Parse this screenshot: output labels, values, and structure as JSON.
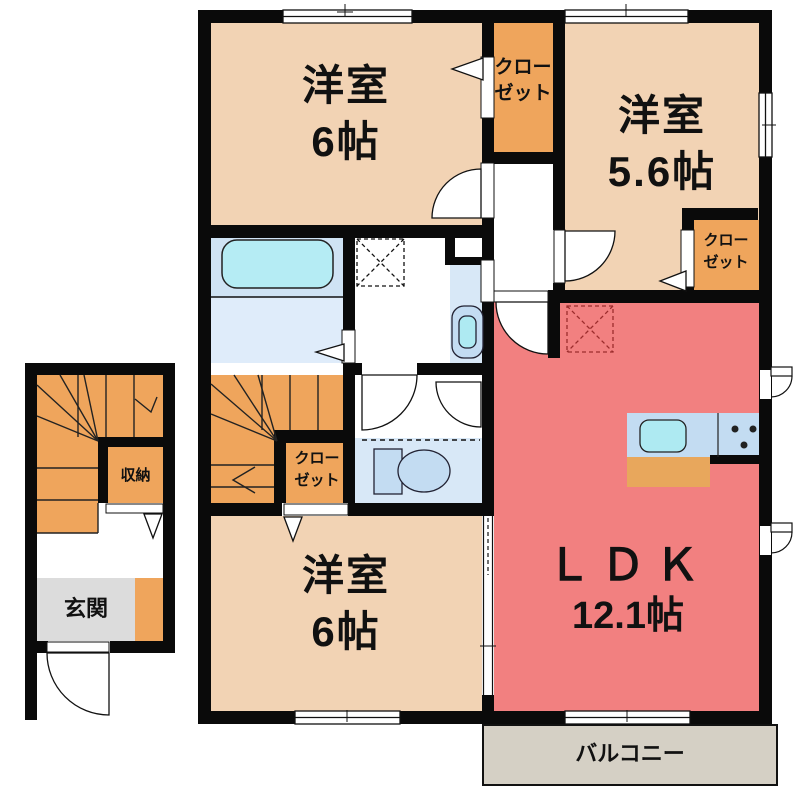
{
  "rooms": {
    "bedroom_top_left": {
      "name": "洋室",
      "size": "6帖"
    },
    "bedroom_top_right": {
      "name": "洋室",
      "size": "5.6帖"
    },
    "bedroom_bottom": {
      "name": "洋室",
      "size": "6帖"
    },
    "ldk": {
      "name": "ＬＤＫ",
      "size": "12.1帖"
    },
    "closet_top": {
      "line1": "クロー",
      "line2": "ゼット"
    },
    "closet_right": {
      "line1": "クロー",
      "line2": "ゼット"
    },
    "closet_middle": {
      "line1": "クロー",
      "line2": "ゼット"
    },
    "storage": {
      "name": "収納"
    },
    "entrance": {
      "name": "玄関"
    },
    "balcony": {
      "name": "バルコニー"
    }
  },
  "colors": {
    "wall_black": "#0a0a0a",
    "room_peach": "#f2d3b4",
    "closet_orange": "#efa55c",
    "ldk_red": "#f28080",
    "balcony_beige": "#d5d0c5",
    "entrance_gray": "#dcdcdc",
    "bath_blue": "#cfe3f4",
    "washroom_blue": "#dfecfa",
    "toilet_blue": "#d8e8f7",
    "fixture_blue": "#c3dcf2",
    "tub_cyan": "#b5ecf4",
    "sink_cyan": "#aeeaf2",
    "cabinet_orange": "#e8a75c",
    "fridge_dash_red": "#9b2c2c"
  }
}
